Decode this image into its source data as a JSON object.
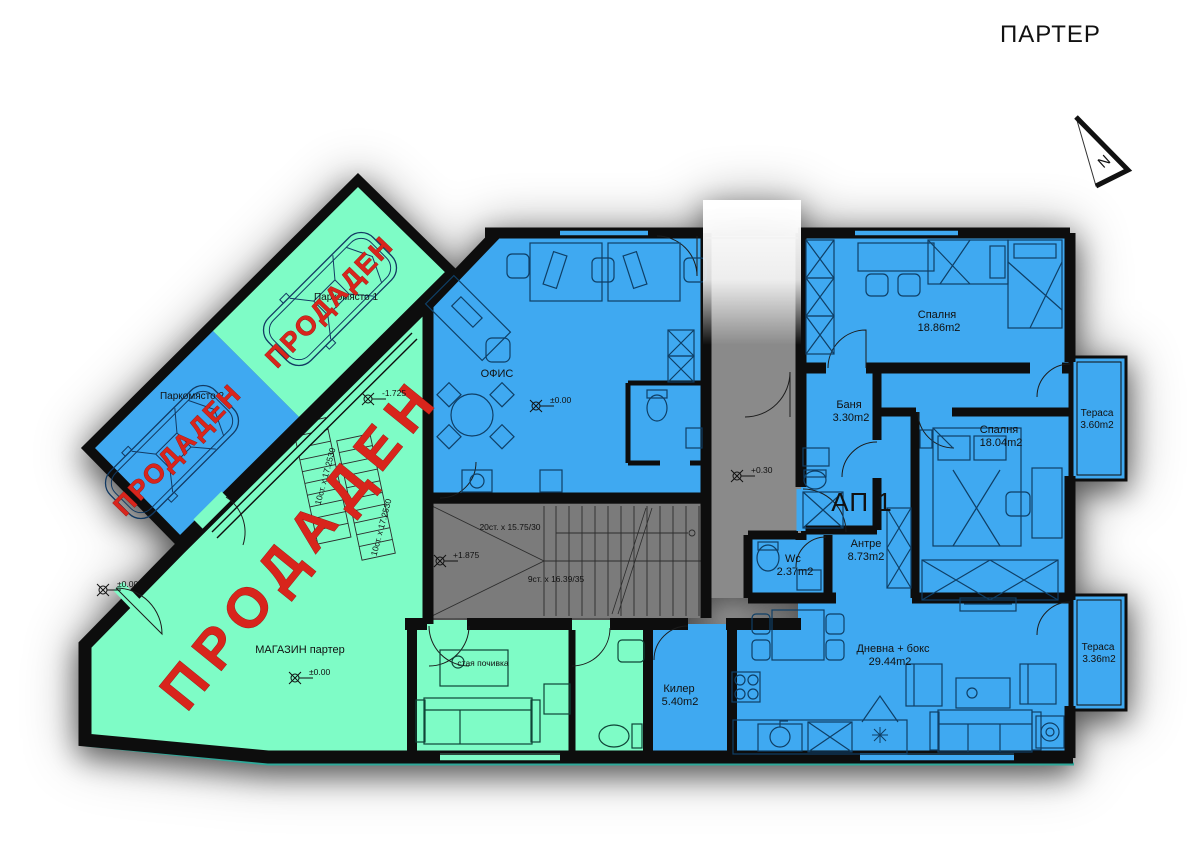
{
  "header": {
    "title": "ПАРТЕР"
  },
  "north": {
    "label": "N"
  },
  "sold": {
    "label": "ПРОДАДЕН"
  },
  "parking": {
    "space1": {
      "label": "Паркомясто 1"
    },
    "space2": {
      "label": "Паркомясто 2"
    }
  },
  "shop": {
    "label": "МАГАЗИН партер",
    "elev1": "±0.00",
    "elev2": "±0.00"
  },
  "rest_room": {
    "label": "стая почивка"
  },
  "office": {
    "label": "ОФИС",
    "elev": "±0.00"
  },
  "apartment": {
    "label": "АП 1",
    "bedroom1": {
      "name": "Спалня",
      "area": "18.86m2"
    },
    "bedroom2": {
      "name": "Спалня",
      "area": "18.04m2"
    },
    "bath": {
      "name": "Баня",
      "area": "3.30m2"
    },
    "hall": {
      "name": "Антре",
      "area": "8.73m2"
    },
    "wc": {
      "name": "Wc",
      "area": "2.37m2"
    },
    "living": {
      "name": "Дневна + бокс",
      "area": "29.44m2"
    },
    "closet": {
      "name": "Килер",
      "area": "5.40m2"
    },
    "terrace1": {
      "name": "Тераса",
      "area": "3.60m2"
    },
    "terrace2": {
      "name": "Тераса",
      "area": "3.36m2"
    }
  },
  "stairs": {
    "exterior1": "10ст. x 17.2530",
    "exterior2": "10ст. x 17.2530",
    "main_upper": "20ст. x 15.75/30",
    "main_lower": "9ст. x 16.39/35"
  },
  "elevations": {
    "office": "±0.00",
    "corridor": "+0.30",
    "stair_mid": "+1.875",
    "parking": "-1.725"
  },
  "colors": {
    "room_blue": "#3fa9f1",
    "room_green": "#7efcc6",
    "stair_gray": "#7b7b7b",
    "corridor_gray": "#8a8a8a",
    "wall_black": "#0d0d0d",
    "sold_red": "#d8251c",
    "edge_teal": "#2ea899"
  }
}
